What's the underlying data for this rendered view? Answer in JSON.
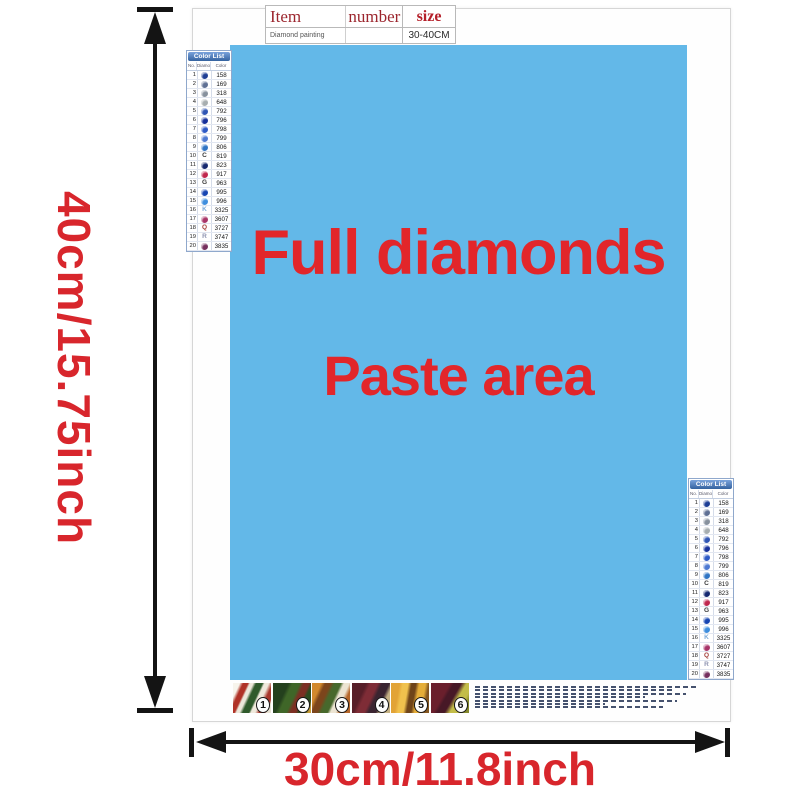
{
  "colors": {
    "paste_bg": "#63b8e8",
    "paste_text": "#e2262a",
    "accent_red": "#d8262c",
    "arrow": "#141414",
    "list_header_bg": "#34629f",
    "table_header_text": "#9c262e",
    "size_header_text": "#b5202a"
  },
  "size_labels": {
    "height": "40cm/15.75inch",
    "width": "30cm/11.8inch"
  },
  "item_table": {
    "headers": [
      "Item",
      "number",
      "size"
    ],
    "row": {
      "item": "Diamond painting",
      "number": "",
      "size": "30-40CM"
    }
  },
  "paste_area": {
    "line1": "Full diamonds",
    "line2": "Paste area"
  },
  "color_list": {
    "title": "Color List",
    "columns": [
      "No.",
      "Diamond",
      "Color"
    ],
    "rows": [
      {
        "no": "1",
        "symbol": "circle",
        "color": "#1e3e95",
        "code": "158"
      },
      {
        "no": "2",
        "symbol": "circle",
        "color": "#5f7094",
        "code": "169"
      },
      {
        "no": "3",
        "symbol": "circle",
        "color": "#87919d",
        "code": "318"
      },
      {
        "no": "4",
        "symbol": "circle",
        "color": "#a7aeb0",
        "code": "648"
      },
      {
        "no": "5",
        "symbol": "circle",
        "color": "#2f55b4",
        "code": "792"
      },
      {
        "no": "6",
        "symbol": "circle",
        "color": "#16309b",
        "code": "796"
      },
      {
        "no": "7",
        "symbol": "circle",
        "color": "#2d5ac6",
        "code": "798"
      },
      {
        "no": "8",
        "symbol": "circle",
        "color": "#4d79d2",
        "code": "799"
      },
      {
        "no": "9",
        "symbol": "circle",
        "color": "#2f74c4",
        "code": "806"
      },
      {
        "no": "10",
        "symbol": "letter",
        "char": "C",
        "color": "#3a3a3a",
        "code": "819"
      },
      {
        "no": "11",
        "symbol": "circle",
        "color": "#14276f",
        "code": "823"
      },
      {
        "no": "12",
        "symbol": "circle",
        "color": "#c0274d",
        "code": "917"
      },
      {
        "no": "13",
        "symbol": "letter",
        "char": "G",
        "color": "#3a3a3a",
        "code": "963"
      },
      {
        "no": "14",
        "symbol": "circle",
        "color": "#1745b2",
        "code": "995"
      },
      {
        "no": "15",
        "symbol": "circle",
        "color": "#3e8ede",
        "code": "996"
      },
      {
        "no": "16",
        "symbol": "letter",
        "char": "K",
        "color": "#7aa9d8",
        "code": "3325"
      },
      {
        "no": "17",
        "symbol": "circle",
        "color": "#a83468",
        "code": "3607"
      },
      {
        "no": "18",
        "symbol": "letter",
        "char": "Q",
        "color": "#a4403a",
        "code": "3727"
      },
      {
        "no": "19",
        "symbol": "letter",
        "char": "R",
        "color": "#8e93b0",
        "code": "3747"
      },
      {
        "no": "20",
        "symbol": "circle",
        "color": "#76305e",
        "code": "3835"
      }
    ]
  },
  "steps": {
    "numbers": [
      "1",
      "2",
      "3",
      "4",
      "5",
      "6"
    ]
  }
}
